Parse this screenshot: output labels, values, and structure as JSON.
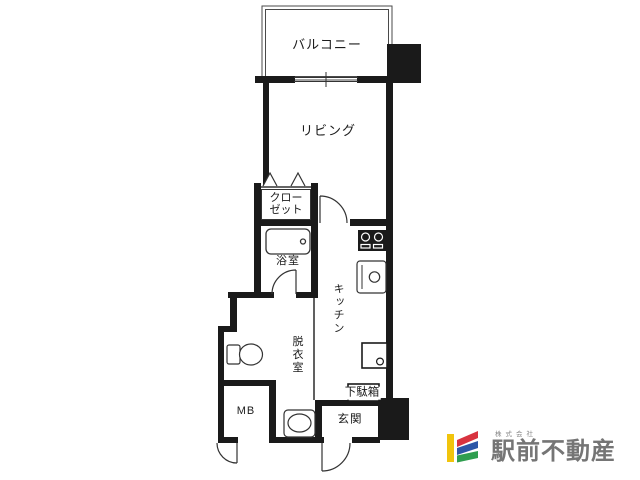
{
  "plan": {
    "wall_color": "#1a1a1a",
    "balcony_label": "バルコニー",
    "living_label": "リビング",
    "closet_label": "クローゼット",
    "bath_label": "浴室",
    "kitchen_label": "キッチン",
    "dressing_label": "脱衣室",
    "meter_box_label": "MB",
    "shoe_cabinet_label": "下駄箱",
    "entrance_label": "玄関"
  },
  "logo": {
    "company_type": "株式会社",
    "company_name": "駅前不動産",
    "text_color": "#757575",
    "bar_yellow": "#f1c40c",
    "bar_red": "#d8333f",
    "bar_blue": "#2d57a7",
    "bar_green": "#2f9e4f"
  }
}
